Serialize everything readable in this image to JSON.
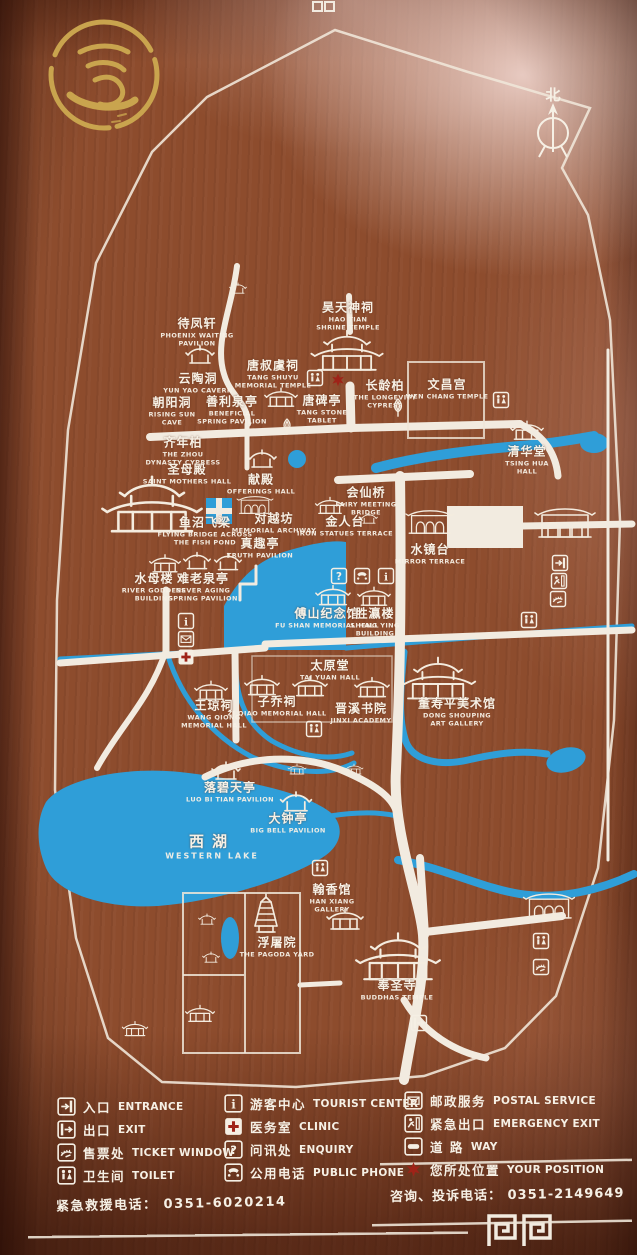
{
  "board": {
    "north_label": "北",
    "colors": {
      "wood": "#8d4c2d",
      "path_white": "#f2ebe0",
      "water_blue": "#2f9ed8",
      "logo_gold": "#c9a44e",
      "marker_red": "#9f2318"
    }
  },
  "map": {
    "labels": [
      {
        "zh": "待凤轩",
        "en": "PHOENIX WAITING\nPAVILION",
        "x": 197,
        "y": 331
      },
      {
        "zh": "昊天神祠",
        "en": "HAO TIAN\nSHRINE TEMPLE",
        "x": 348,
        "y": 315
      },
      {
        "zh": "唐叔虞祠",
        "en": "TANG SHUYU\nMEMORIAL TEMPLE",
        "x": 273,
        "y": 373
      },
      {
        "zh": "云陶洞",
        "en": "YUN YAO CAVERN",
        "x": 198,
        "y": 382
      },
      {
        "zh": "朝阳洞",
        "en": "RISING SUN\nCAVE",
        "x": 172,
        "y": 410
      },
      {
        "zh": "善利泉亭",
        "en": "BENEFICIAL\nSPRING PAVILION",
        "x": 232,
        "y": 409
      },
      {
        "zh": "唐碑亭",
        "en": "TANG STONE\nTABLET",
        "x": 322,
        "y": 408
      },
      {
        "zh": "长龄柏",
        "en": "THE LONGEVITY\nCYPRESS",
        "x": 385,
        "y": 393
      },
      {
        "zh": "文昌宫",
        "en": "WEN CHANG TEMPLE",
        "x": 447,
        "y": 388
      },
      {
        "zh": "清华堂",
        "en": "TSING HUA\nHALL",
        "x": 527,
        "y": 459
      },
      {
        "zh": "齐年柏",
        "en": "THE ZHOU\nDYNASTY CYPRESS",
        "x": 183,
        "y": 450
      },
      {
        "zh": "圣母殿",
        "en": "SAINT MOTHERS HALL",
        "x": 187,
        "y": 473
      },
      {
        "zh": "献殿",
        "en": "OFFERINGS HALL",
        "x": 261,
        "y": 483
      },
      {
        "zh": "鱼沼飞梁",
        "en": "FLYING BRIDGE ACROSS\nTHE FISH POND",
        "x": 205,
        "y": 530
      },
      {
        "zh": "对越坊",
        "en": "MEMORIAL ARCHWAY",
        "x": 274,
        "y": 522
      },
      {
        "zh": "金人台",
        "en": "IRON STATUES TERRACE",
        "x": 345,
        "y": 525
      },
      {
        "zh": "会仙桥",
        "en": "FAIRY MEETING\nBRIDGE",
        "x": 366,
        "y": 500
      },
      {
        "zh": "水镜台",
        "en": "MIRROR TERRACE",
        "x": 430,
        "y": 553
      },
      {
        "zh": "真趣亭",
        "en": "TRUTH PAVILION",
        "x": 260,
        "y": 547
      },
      {
        "zh": "水母楼",
        "en": "RIVER GODDESS\nBUILDING",
        "x": 154,
        "y": 586
      },
      {
        "zh": "难老泉亭",
        "en": "NEVER AGING\nSPRING PAVILION",
        "x": 203,
        "y": 586
      },
      {
        "zh": "傅山纪念馆",
        "en": "FU SHAN MEMORIAL HALL",
        "x": 327,
        "y": 617
      },
      {
        "zh": "胜瀛楼",
        "en": "SHENG YING\nBUILDING",
        "x": 375,
        "y": 621
      },
      {
        "zh": "太原堂",
        "en": "TAI YUAN HALL",
        "x": 330,
        "y": 669
      },
      {
        "zh": "王琼祠",
        "en": "WANG QIONG\nMEMORIAL HALL",
        "x": 214,
        "y": 713
      },
      {
        "zh": "子乔祠",
        "en": "ZI QIAO MEMORIAL HALL",
        "x": 277,
        "y": 705
      },
      {
        "zh": "晋溪书院",
        "en": "JINXI ACADEMY",
        "x": 361,
        "y": 712
      },
      {
        "zh": "董寿平美术馆",
        "en": "DONG SHOUPING\nART GALLERY",
        "x": 457,
        "y": 711
      },
      {
        "zh": "落碧天亭",
        "en": "LUO BI TIAN PAVILION",
        "x": 230,
        "y": 791
      },
      {
        "zh": "大钟亭",
        "en": "BIG BELL PAVILION",
        "x": 288,
        "y": 822
      },
      {
        "zh": "西湖",
        "en": "WESTERN LAKE",
        "x": 212,
        "y": 846,
        "big": true
      },
      {
        "zh": "翰香馆",
        "en": "HAN XIANG\nGALLERY",
        "x": 332,
        "y": 897
      },
      {
        "zh": "浮屠院",
        "en": "THE PAGODA YARD",
        "x": 277,
        "y": 946
      },
      {
        "zh": "奉圣寺",
        "en": "BUDDHAS TEMPLE",
        "x": 397,
        "y": 989
      }
    ],
    "buildings": [
      {
        "t": "pavilion",
        "x": 200,
        "y": 356,
        "s": 1
      },
      {
        "t": "hall-large",
        "x": 347,
        "y": 356,
        "s": 1.15
      },
      {
        "t": "hall",
        "x": 281,
        "y": 399,
        "s": 0.9
      },
      {
        "t": "tree",
        "x": 398,
        "y": 408,
        "s": 0.9
      },
      {
        "t": "tree",
        "x": 287,
        "y": 427,
        "s": 0.8
      },
      {
        "t": "pavilion",
        "x": 238,
        "y": 289,
        "s": 0.6
      },
      {
        "t": "hall",
        "x": 527,
        "y": 432,
        "s": 0.9
      },
      {
        "t": "hall-large",
        "x": 152,
        "y": 512,
        "s": 1.6
      },
      {
        "t": "pavilion",
        "x": 262,
        "y": 460,
        "s": 1
      },
      {
        "t": "gate",
        "x": 255,
        "y": 505,
        "s": 0.6
      },
      {
        "t": "hall",
        "x": 330,
        "y": 507,
        "s": 0.8
      },
      {
        "t": "pavilion",
        "x": 369,
        "y": 519,
        "s": 0.6
      },
      {
        "t": "gate",
        "x": 430,
        "y": 522,
        "s": 0.8
      },
      {
        "t": "hall",
        "x": 165,
        "y": 565,
        "s": 0.85
      },
      {
        "t": "pavilion",
        "x": 197,
        "y": 562,
        "s": 0.95
      },
      {
        "t": "pavilion",
        "x": 228,
        "y": 563,
        "s": 0.95
      },
      {
        "t": "hall",
        "x": 333,
        "y": 597,
        "s": 0.95
      },
      {
        "t": "hall",
        "x": 374,
        "y": 598,
        "s": 0.9
      },
      {
        "t": "hall",
        "x": 211,
        "y": 692,
        "s": 0.9
      },
      {
        "t": "hall",
        "x": 262,
        "y": 687,
        "s": 0.95
      },
      {
        "t": "hall",
        "x": 310,
        "y": 688,
        "s": 0.95
      },
      {
        "t": "hall",
        "x": 372,
        "y": 689,
        "s": 0.95
      },
      {
        "t": "hall-large",
        "x": 438,
        "y": 684,
        "s": 1.2
      },
      {
        "t": "pavilion",
        "x": 226,
        "y": 772,
        "s": 1
      },
      {
        "t": "pavilion",
        "x": 296,
        "y": 803,
        "s": 1.1
      },
      {
        "t": "hall",
        "x": 297,
        "y": 770,
        "s": 0.5
      },
      {
        "t": "hall",
        "x": 354,
        "y": 770,
        "s": 0.5
      },
      {
        "t": "hall",
        "x": 345,
        "y": 921,
        "s": 1
      },
      {
        "t": "pagoda",
        "x": 266,
        "y": 918,
        "s": 1
      },
      {
        "t": "pavilion",
        "x": 207,
        "y": 920,
        "s": 0.6
      },
      {
        "t": "pavilion",
        "x": 211,
        "y": 958,
        "s": 0.6
      },
      {
        "t": "hall-large",
        "x": 398,
        "y": 963,
        "s": 1.35
      },
      {
        "t": "gate",
        "x": 565,
        "y": 523,
        "s": 1
      },
      {
        "t": "gate",
        "x": 549,
        "y": 906,
        "s": 0.85
      },
      {
        "t": "hall",
        "x": 200,
        "y": 1015,
        "s": 0.8
      },
      {
        "t": "hall",
        "x": 135,
        "y": 1030,
        "s": 0.7
      }
    ],
    "facilities": [
      {
        "t": "toilet",
        "x": 315,
        "y": 378
      },
      {
        "t": "position",
        "x": 338,
        "y": 380
      },
      {
        "t": "toilet",
        "x": 501,
        "y": 400
      },
      {
        "t": "enquiry",
        "x": 339,
        "y": 576
      },
      {
        "t": "phone",
        "x": 362,
        "y": 576
      },
      {
        "t": "info",
        "x": 386,
        "y": 576
      },
      {
        "t": "info",
        "x": 186,
        "y": 621
      },
      {
        "t": "postal",
        "x": 186,
        "y": 639
      },
      {
        "t": "clinic",
        "x": 186,
        "y": 657
      },
      {
        "t": "toilet",
        "x": 314,
        "y": 729
      },
      {
        "t": "toilet",
        "x": 320,
        "y": 868
      },
      {
        "t": "entrance",
        "x": 560,
        "y": 563
      },
      {
        "t": "emergency",
        "x": 559,
        "y": 581
      },
      {
        "t": "ticket",
        "x": 558,
        "y": 599
      },
      {
        "t": "toilet",
        "x": 529,
        "y": 620
      },
      {
        "t": "toilet",
        "x": 541,
        "y": 941
      },
      {
        "t": "ticket",
        "x": 541,
        "y": 967
      },
      {
        "t": "exit",
        "x": 419,
        "y": 1023
      }
    ]
  },
  "legend": {
    "columns": [
      [
        {
          "icon": "entrance",
          "zh": "入口",
          "en": "ENTRANCE"
        },
        {
          "icon": "exit",
          "zh": "出口",
          "en": "EXIT"
        },
        {
          "icon": "ticket",
          "zh": "售票处",
          "en": "TICKET WINDOW"
        },
        {
          "icon": "toilet",
          "zh": "卫生间",
          "en": "TOILET"
        }
      ],
      [
        {
          "icon": "info",
          "zh": "游客中心",
          "en": "TOURIST CENTER"
        },
        {
          "icon": "clinic",
          "zh": "医务室",
          "en": "CLINIC"
        },
        {
          "icon": "enquiry",
          "zh": "问讯处",
          "en": "ENQUIRY"
        },
        {
          "icon": "phone",
          "zh": "公用电话",
          "en": "PUBLIC PHONE"
        }
      ],
      [
        {
          "icon": "postal",
          "zh": "邮政服务",
          "en": "POSTAL SERVICE"
        },
        {
          "icon": "emergency",
          "zh": "紧急出口",
          "en": "EMERGENCY EXIT"
        },
        {
          "icon": "way",
          "zh": "道  路",
          "en": "WAY"
        },
        {
          "icon": "position",
          "zh": "您所处位置",
          "en": "YOUR POSITION"
        }
      ]
    ]
  },
  "footer": {
    "emergency_phone_label": "紧急救援电话：",
    "emergency_phone": "0351-6020214",
    "enquiry_phone_label": "咨询、投诉电话：",
    "enquiry_phone": "0351-2149649"
  }
}
